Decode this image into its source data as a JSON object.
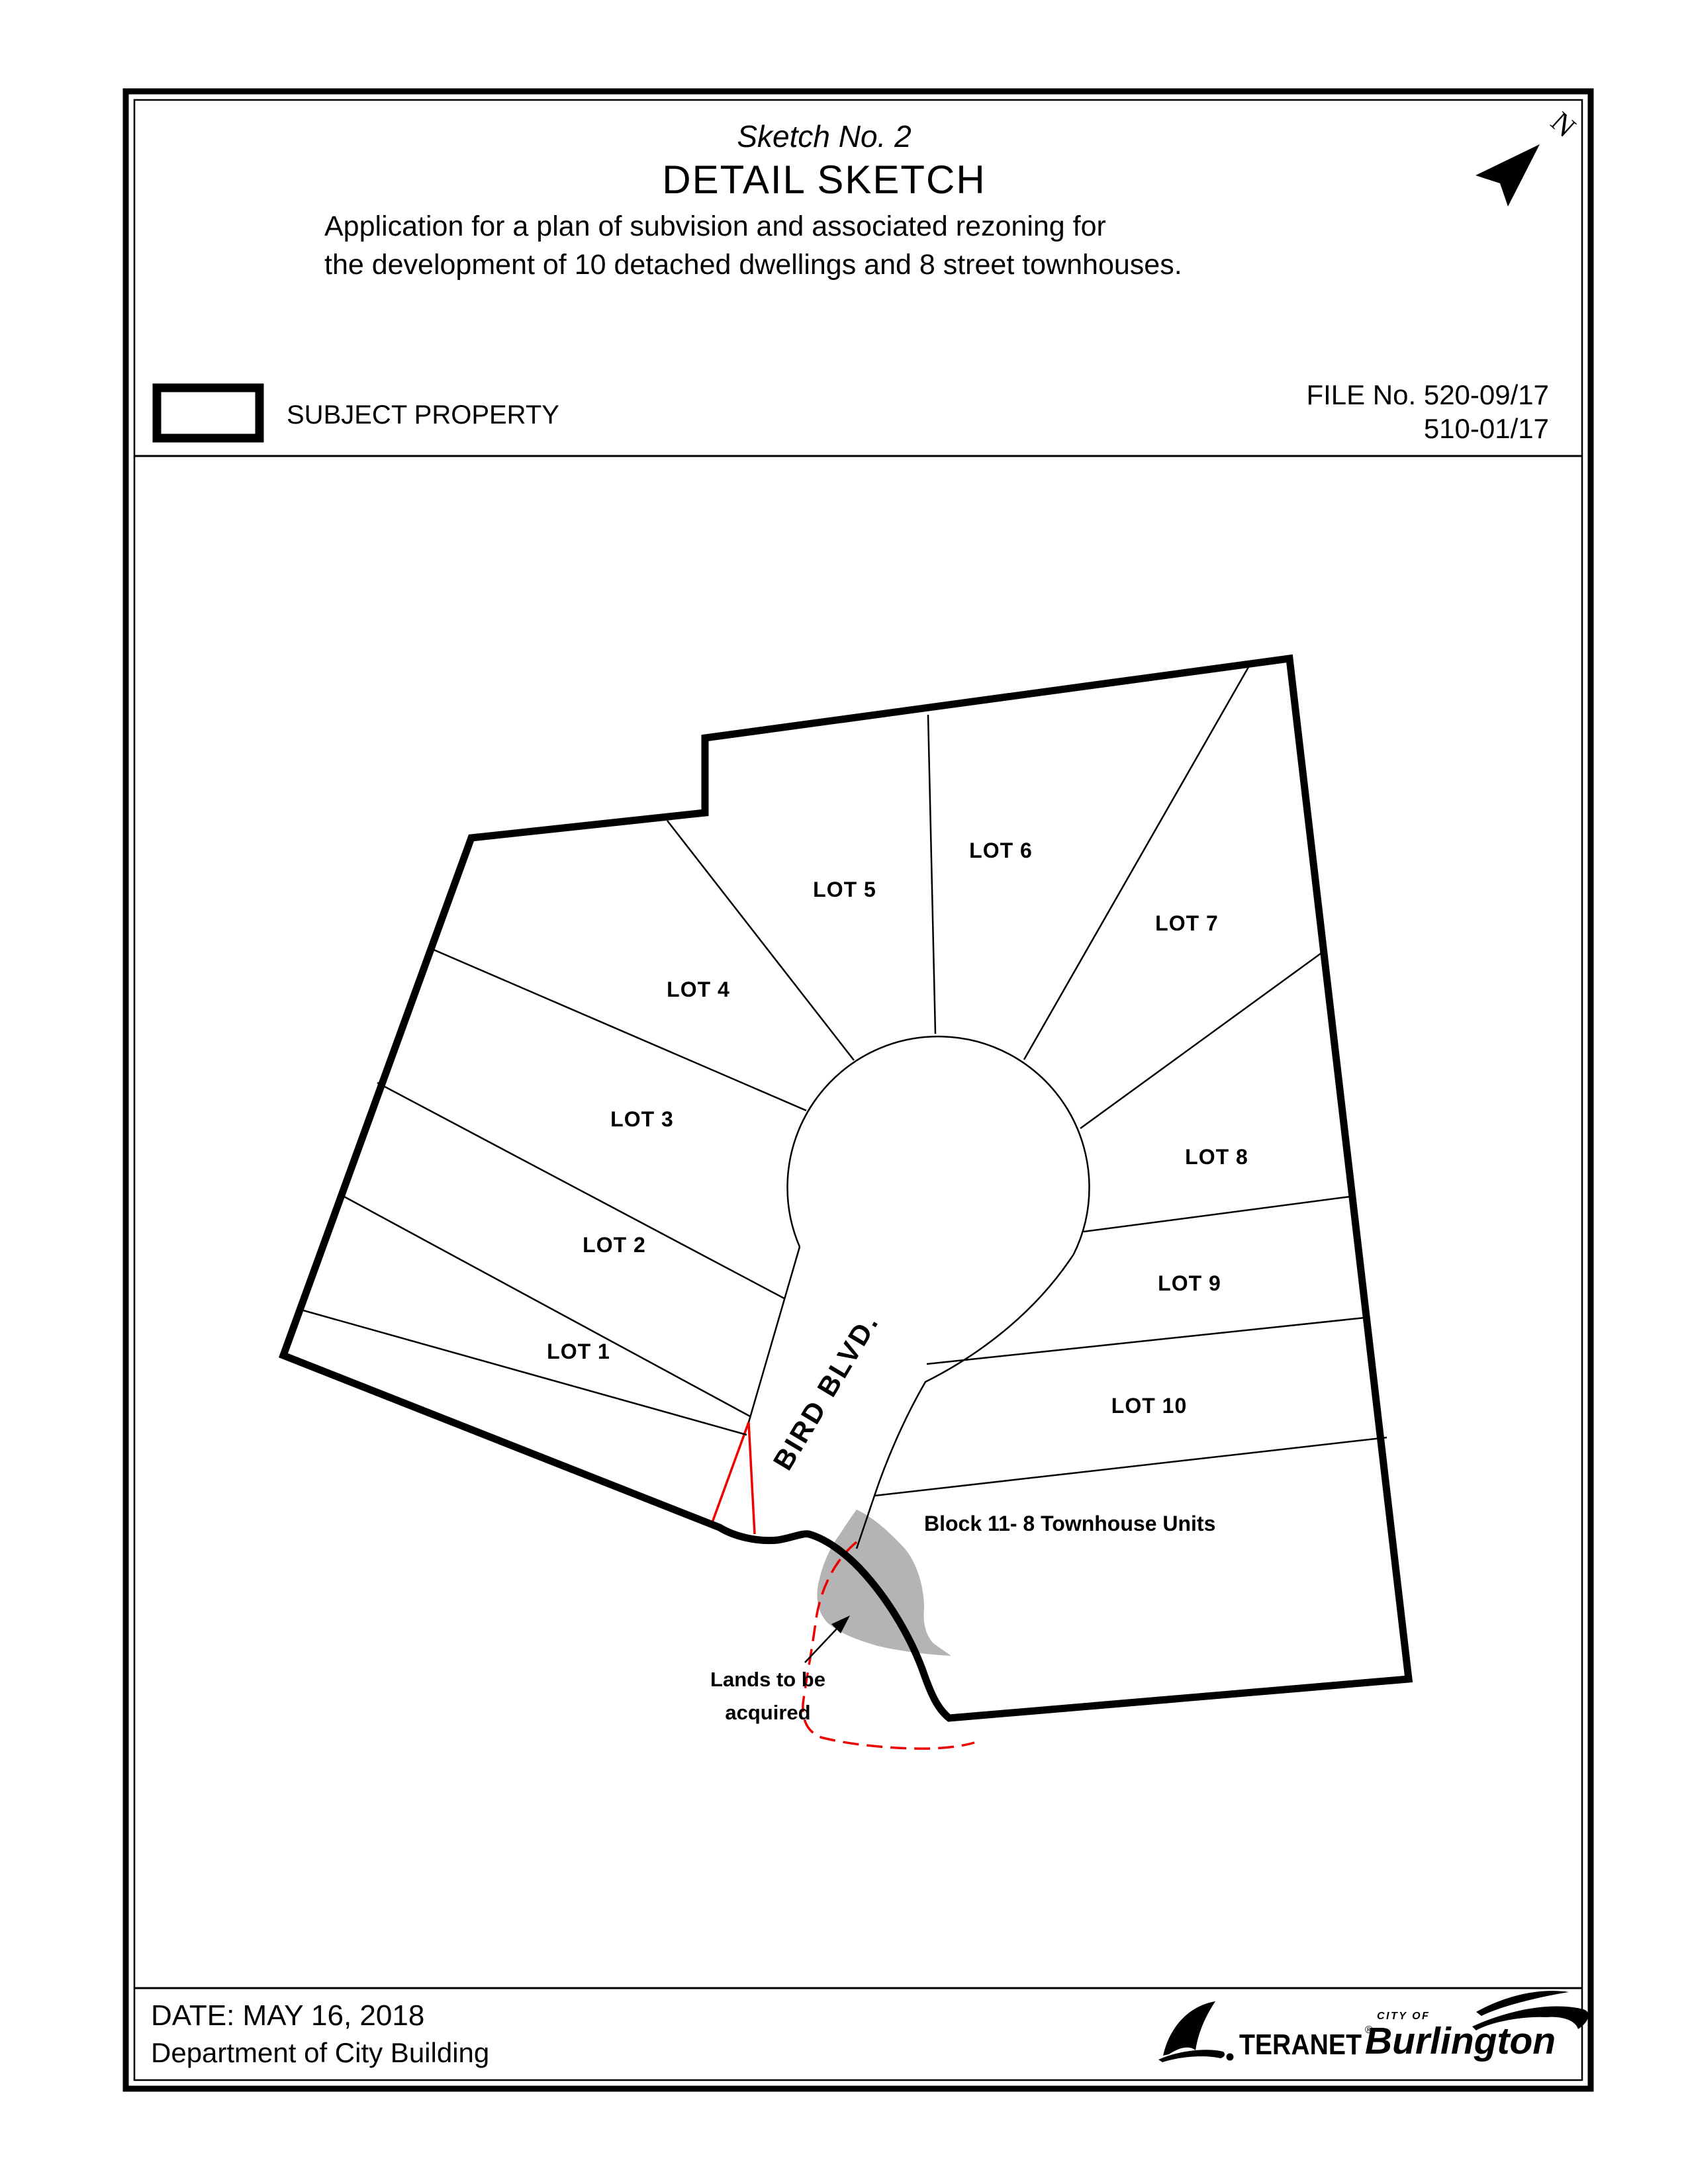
{
  "header": {
    "sketch_no": "Sketch No. 2",
    "title": "DETAIL SKETCH",
    "description_line1": "Application for a plan of subvision and associated rezoning for",
    "description_line2": "the development of 10 detached dwellings and 8 street townhouses.",
    "legend_label": "SUBJECT PROPERTY",
    "file_no_line1": "FILE No. 520-09/17",
    "file_no_line2": "510-01/17",
    "north_label": "N"
  },
  "map": {
    "lot_labels": [
      "LOT 1",
      "LOT 2",
      "LOT 3",
      "LOT 4",
      "LOT 5",
      "LOT 6",
      "LOT 7",
      "LOT 8",
      "LOT 9",
      "LOT 10"
    ],
    "street_label": "BIRD BLVD.",
    "block_label": "Block 11- 8 Townhouse Units",
    "lands_label_line1": "Lands to be",
    "lands_label_line2": "acquired"
  },
  "footer": {
    "date": "DATE: MAY 16, 2018",
    "department": "Department of City Building",
    "teranet_text": "TERANET",
    "teranet_reg": "®",
    "burlington_city_of": "CITY OF",
    "burlington_name": "Burlington"
  },
  "colors": {
    "line_black": "#000000",
    "highlight_red": "#ee0000",
    "lands_gray": "#b4b4b4"
  }
}
